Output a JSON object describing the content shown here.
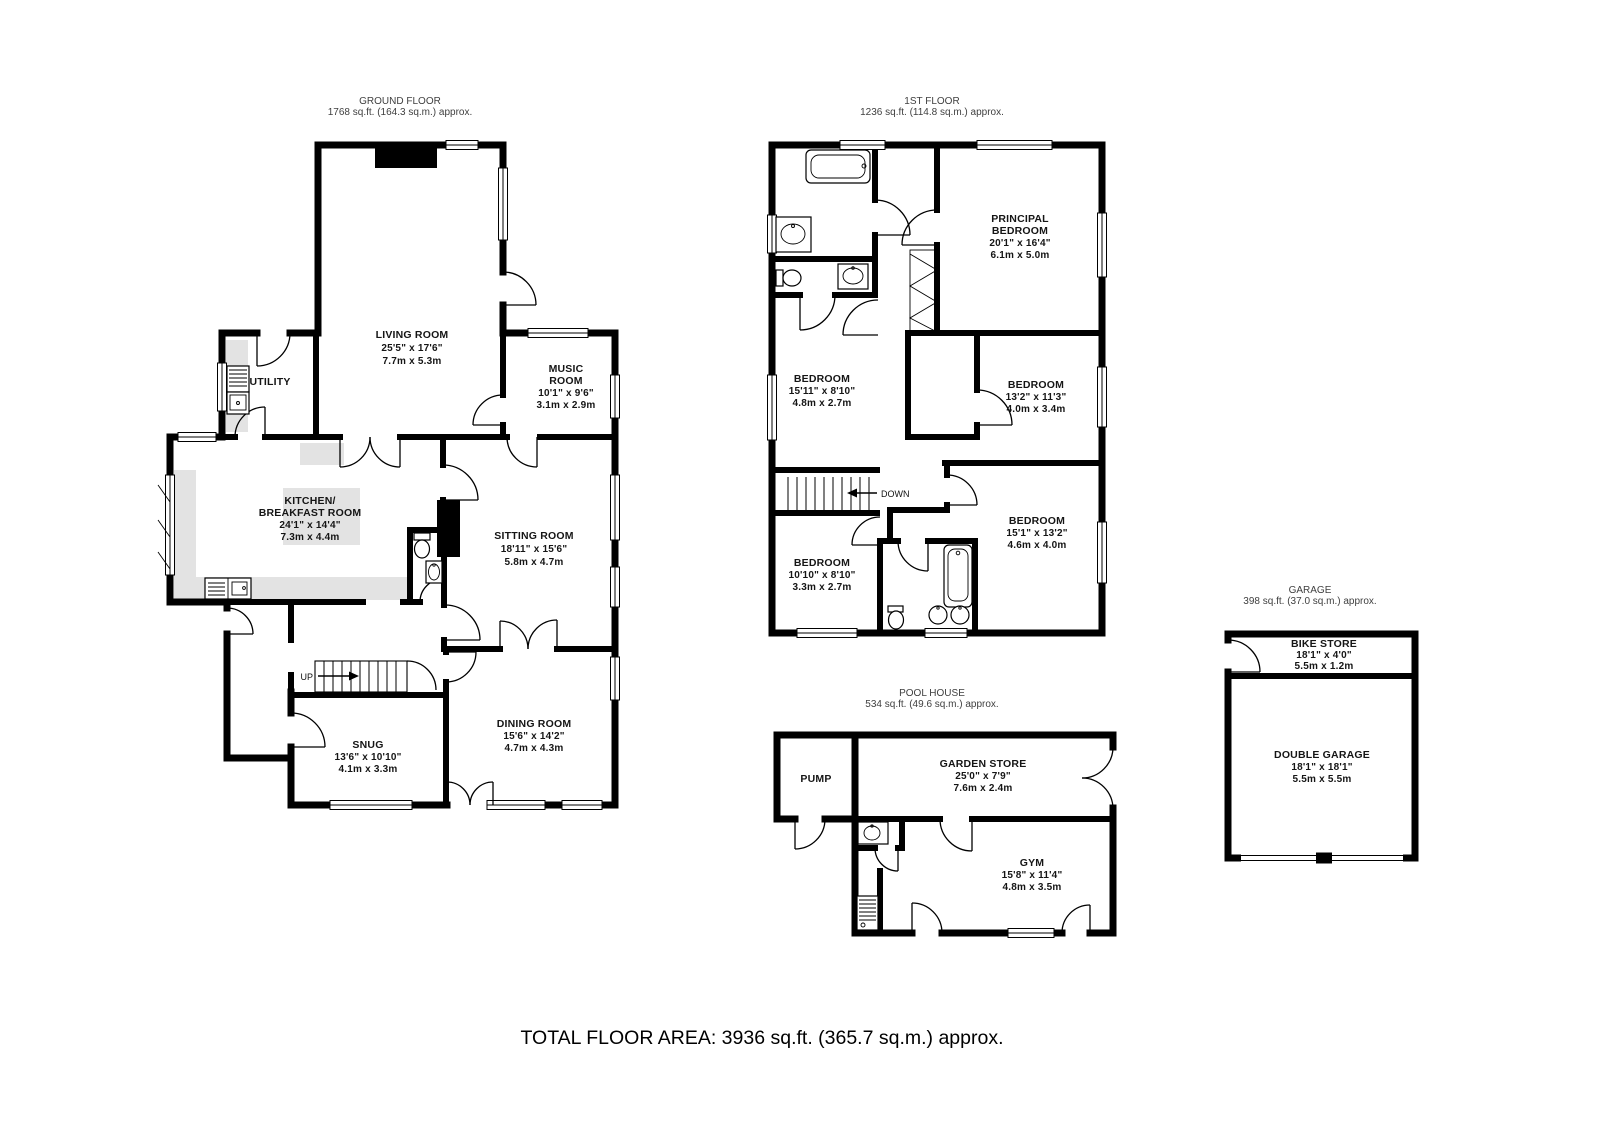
{
  "floors": {
    "ground": {
      "title": "GROUND FLOOR",
      "area": "1768 sq.ft. (164.3 sq.m.) approx."
    },
    "first": {
      "title": "1ST FLOOR",
      "area": "1236 sq.ft. (114.8 sq.m.) approx."
    },
    "pool_house": {
      "title": "POOL HOUSE",
      "area": "534 sq.ft. (49.6 sq.m.) approx."
    },
    "garage": {
      "title": "GARAGE",
      "area": "398 sq.ft. (37.0 sq.m.) approx."
    }
  },
  "rooms": {
    "living_room": {
      "name": "LIVING ROOM",
      "imperial": "25'5\" x 17'6\"",
      "metric": "7.7m x 5.3m"
    },
    "music_room": {
      "name1": "MUSIC",
      "name2": "ROOM",
      "imperial": "10'1\" x 9'6\"",
      "metric": "3.1m x 2.9m"
    },
    "utility": {
      "name": "UTILITY"
    },
    "kitchen": {
      "name1": "KITCHEN/",
      "name2": "BREAKFAST ROOM",
      "imperial": "24'1\" x 14'4\"",
      "metric": "7.3m x 4.4m"
    },
    "sitting_room": {
      "name": "SITTING ROOM",
      "imperial": "18'11\" x 15'6\"",
      "metric": "5.8m x 4.7m"
    },
    "snug": {
      "name": "SNUG",
      "imperial": "13'6\" x 10'10\"",
      "metric": "4.1m x 3.3m"
    },
    "dining_room": {
      "name": "DINING ROOM",
      "imperial": "15'6\" x 14'2\"",
      "metric": "4.7m x 4.3m"
    },
    "principal_bedroom": {
      "name1": "PRINCIPAL",
      "name2": "BEDROOM",
      "imperial": "20'1\" x 16'4\"",
      "metric": "6.1m x 5.0m"
    },
    "bedroom_left": {
      "name": "BEDROOM",
      "imperial": "15'11\" x 8'10\"",
      "metric": "4.8m x 2.7m"
    },
    "bedroom_right_mid": {
      "name": "BEDROOM",
      "imperial": "13'2\" x 11'3\"",
      "metric": "4.0m x 3.4m"
    },
    "bedroom_right_low": {
      "name": "BEDROOM",
      "imperial": "15'1\" x 13'2\"",
      "metric": "4.6m x 4.0m"
    },
    "bedroom_left_low": {
      "name": "BEDROOM",
      "imperial": "10'10\" x 8'10\"",
      "metric": "3.3m x 2.7m"
    },
    "pump": {
      "name": "PUMP"
    },
    "garden_store": {
      "name": "GARDEN STORE",
      "imperial": "25'0\" x 7'9\"",
      "metric": "7.6m x 2.4m"
    },
    "gym": {
      "name": "GYM",
      "imperial": "15'8\" x 11'4\"",
      "metric": "4.8m x 3.5m"
    },
    "bike_store": {
      "name": "BIKE STORE",
      "imperial": "18'1\" x 4'0\"",
      "metric": "5.5m x 1.2m"
    },
    "double_garage": {
      "name": "DOUBLE GARAGE",
      "imperial": "18'1\" x 18'1\"",
      "metric": "5.5m x 5.5m"
    }
  },
  "stairs": {
    "up": "UP",
    "down": "DOWN"
  },
  "footer": {
    "total": "TOTAL FLOOR AREA: 3936 sq.ft. (365.7 sq.m.) approx."
  },
  "colors": {
    "wall": "#000000",
    "counter": "#e3e3e3",
    "accent_text": "#151515"
  }
}
